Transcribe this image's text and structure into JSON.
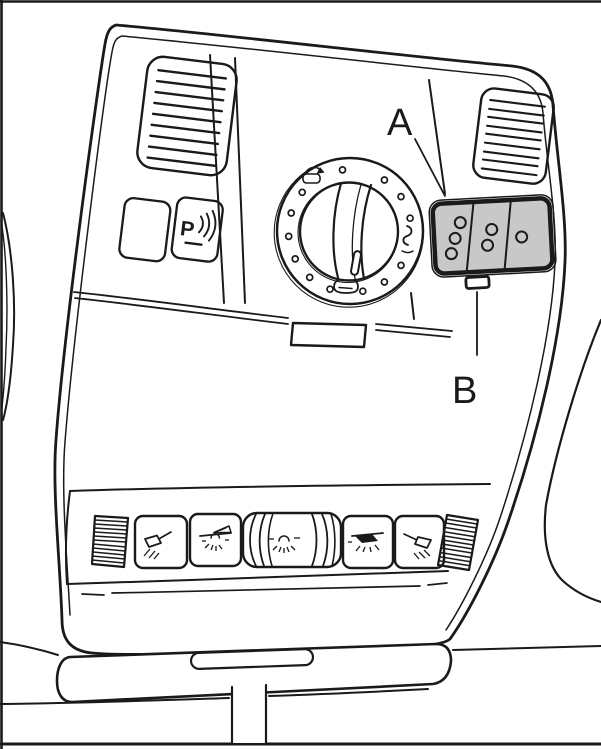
{
  "diagram": {
    "type": "line-art illustration of a car overhead control console",
    "callout_a": "A",
    "callout_b": "B"
  },
  "parktronic_button": {
    "label": "P"
  },
  "colors": {
    "line": "#1a1a1a",
    "background": "#ffffff",
    "panel_a_fill": "#c8c8c8"
  },
  "icons": [
    "parktronic-waves-icon",
    "sunroof-slide-open-icon",
    "sunroof-tilt-icon",
    "sunroof-close-icon",
    "reading-light-left-icon",
    "front-interior-light-icon",
    "dimmer-light-icon",
    "rear-interior-light-icon",
    "reading-light-right-icon",
    "vent-grille-icon",
    "speaker-grille-icon"
  ]
}
